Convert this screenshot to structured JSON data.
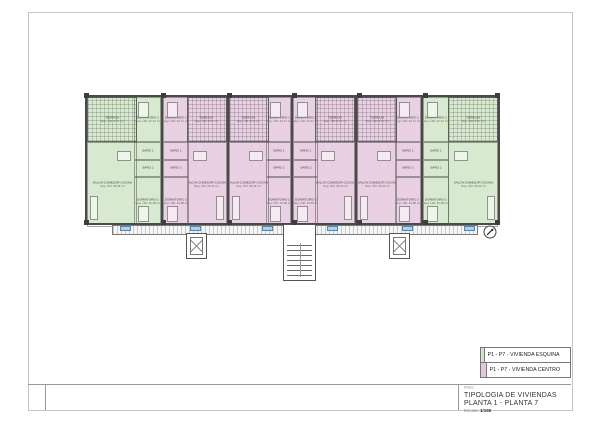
{
  "sheet": {
    "title_block": {
      "field_label": "Plano:",
      "title_line1": "TIPOLOGIA DE VIVIENDAS",
      "title_line2": "PLANTA 1 - PLANTA 7",
      "scale_label": "Escala:",
      "scale_value": "1/150"
    },
    "legend": {
      "items": [
        {
          "label": "P1 - P7 - VIVIENDA ESQUINA",
          "color": "#cfe7c6"
        },
        {
          "label": "P1 - P7 - VIVIENDA CENTRO",
          "color": "#e7c6de"
        }
      ]
    }
  },
  "plan": {
    "colors": {
      "esquina": "#d7eacf",
      "centro": "#ead0e3",
      "wall": "#4a4a4a",
      "tag_fill": "#a9d3ef"
    },
    "rooms": {
      "terraza": {
        "name": "TERRAZA",
        "area": "Sup. Útil: 8.27 m²"
      },
      "dorm1": {
        "name": "DORMITORIO 1",
        "area": "Sup. Útil: 12.17 m²"
      },
      "dorm2": {
        "name": "DORMITORIO 2",
        "area": "Sup. Útil: 10.38 m²"
      },
      "bano1": {
        "name": "BAÑO 1",
        "area": ""
      },
      "bano2": {
        "name": "BAÑO 2",
        "area": ""
      },
      "salon": {
        "name": "SALON-COMEDOR-COCINA",
        "area": "Sup. Útil: 26.41 m²"
      }
    },
    "units": [
      {
        "id": "vivienda-esquina-1",
        "type": "esquina",
        "variant": "terraza-left",
        "width": 77
      },
      {
        "id": "vivienda-centro-1",
        "type": "centro",
        "variant": "terraza-right",
        "width": 66
      },
      {
        "id": "vivienda-centro-2",
        "type": "centro",
        "variant": "terraza-left",
        "width": 65
      },
      {
        "id": "vivienda-centro-3",
        "type": "centro",
        "variant": "terraza-right",
        "width": 65
      },
      {
        "id": "vivienda-centro-4",
        "type": "centro",
        "variant": "terraza-left",
        "width": 66
      },
      {
        "id": "vivienda-esquina-2",
        "type": "esquina",
        "variant": "terraza-right",
        "width": 76
      }
    ],
    "gallery_tag_positions": [
      120,
      190,
      262,
      327,
      402,
      464
    ]
  }
}
